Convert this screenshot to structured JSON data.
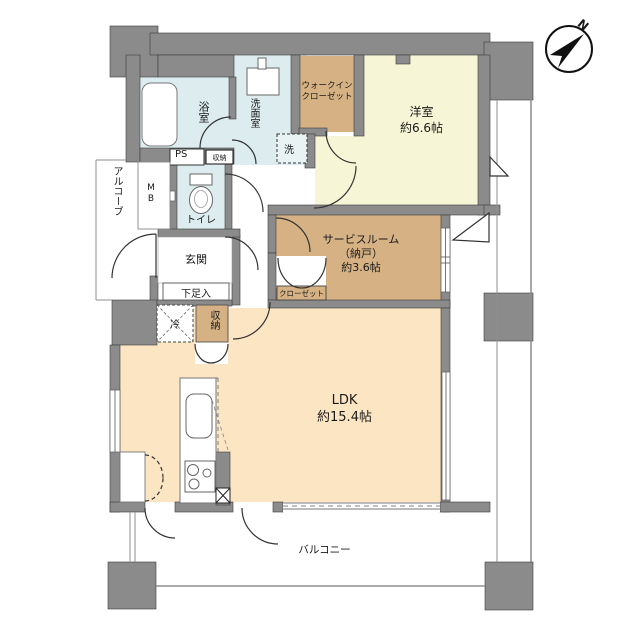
{
  "compass": {
    "north_label": "N"
  },
  "rooms": {
    "western_room": {
      "name": "洋室",
      "size": "約6.6帖"
    },
    "ldk": {
      "name": "LDK",
      "size": "約15.4帖"
    },
    "service_room": {
      "name": "サービスルーム",
      "subname": "（納戸）",
      "size": "約3.6帖"
    },
    "walk_in_closet": {
      "line1": "ウォークイン",
      "line2": "クローゼット"
    },
    "bathroom": {
      "name": "浴室"
    },
    "washroom": {
      "name": "洗面室"
    },
    "toilet": {
      "name": "トイレ"
    },
    "entrance": {
      "name": "玄関"
    },
    "shoe_cabinet": {
      "name": "下足入"
    },
    "alcove": {
      "name": "アルコーブ"
    },
    "balcony": {
      "name": "バルコニー"
    }
  },
  "fixtures": {
    "washing_machine": "洗",
    "refrigerator": "冷",
    "storage_hall": "収納",
    "storage_ldk": "収納",
    "closet": "クローゼット",
    "pipe_space": "PS",
    "meter_box": "MB"
  },
  "colors": {
    "wall": "#8b8b8b",
    "wet_area": "#ddedef",
    "tatami_room": "#f6f5d6",
    "tan_room": "#d5b184",
    "ldk_floor": "#fbe5c3"
  }
}
